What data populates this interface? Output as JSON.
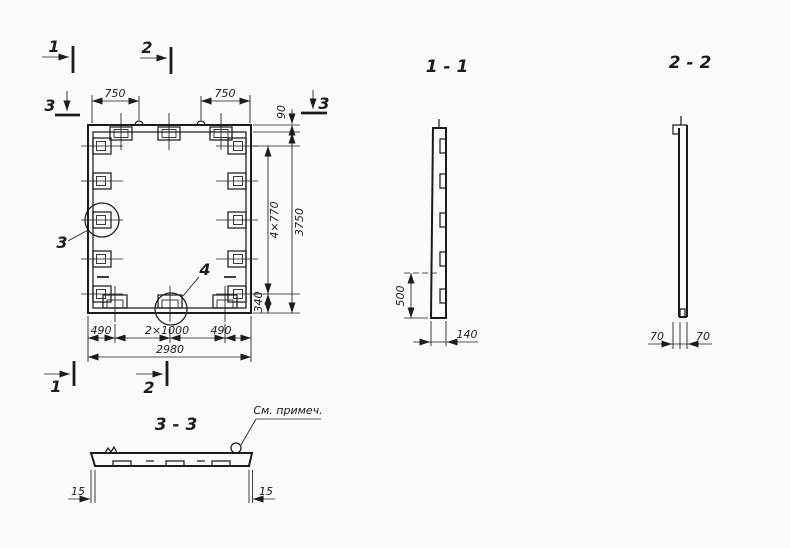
{
  "colors": {
    "ink": "#1c1c1a",
    "paper": "#fbfbf9"
  },
  "plan": {
    "marks": {
      "top_1": "1",
      "top_2": "2",
      "bottom_1": "1",
      "bottom_2": "2",
      "left_3": "3",
      "right_3": "3"
    },
    "callouts": {
      "detail_3": "3",
      "detail_4": "4"
    },
    "dims": {
      "top_left": "750",
      "top_right": "750",
      "edge_90": "90",
      "pitch": "4×770",
      "height": "3750",
      "bottom_offset": "340",
      "bottom_left": "490",
      "bottom_center": "2×1000",
      "bottom_right": "490",
      "width": "2980"
    }
  },
  "sections": {
    "s11": {
      "title": "1 - 1",
      "dim_depth": "500",
      "dim_thickness": "140"
    },
    "s22": {
      "title": "2 - 2",
      "dim_left": "70",
      "dim_right": "70"
    },
    "s33": {
      "title": "3 - 3",
      "note": "См. примеч.",
      "dim_left": "15",
      "dim_right": "15"
    }
  }
}
